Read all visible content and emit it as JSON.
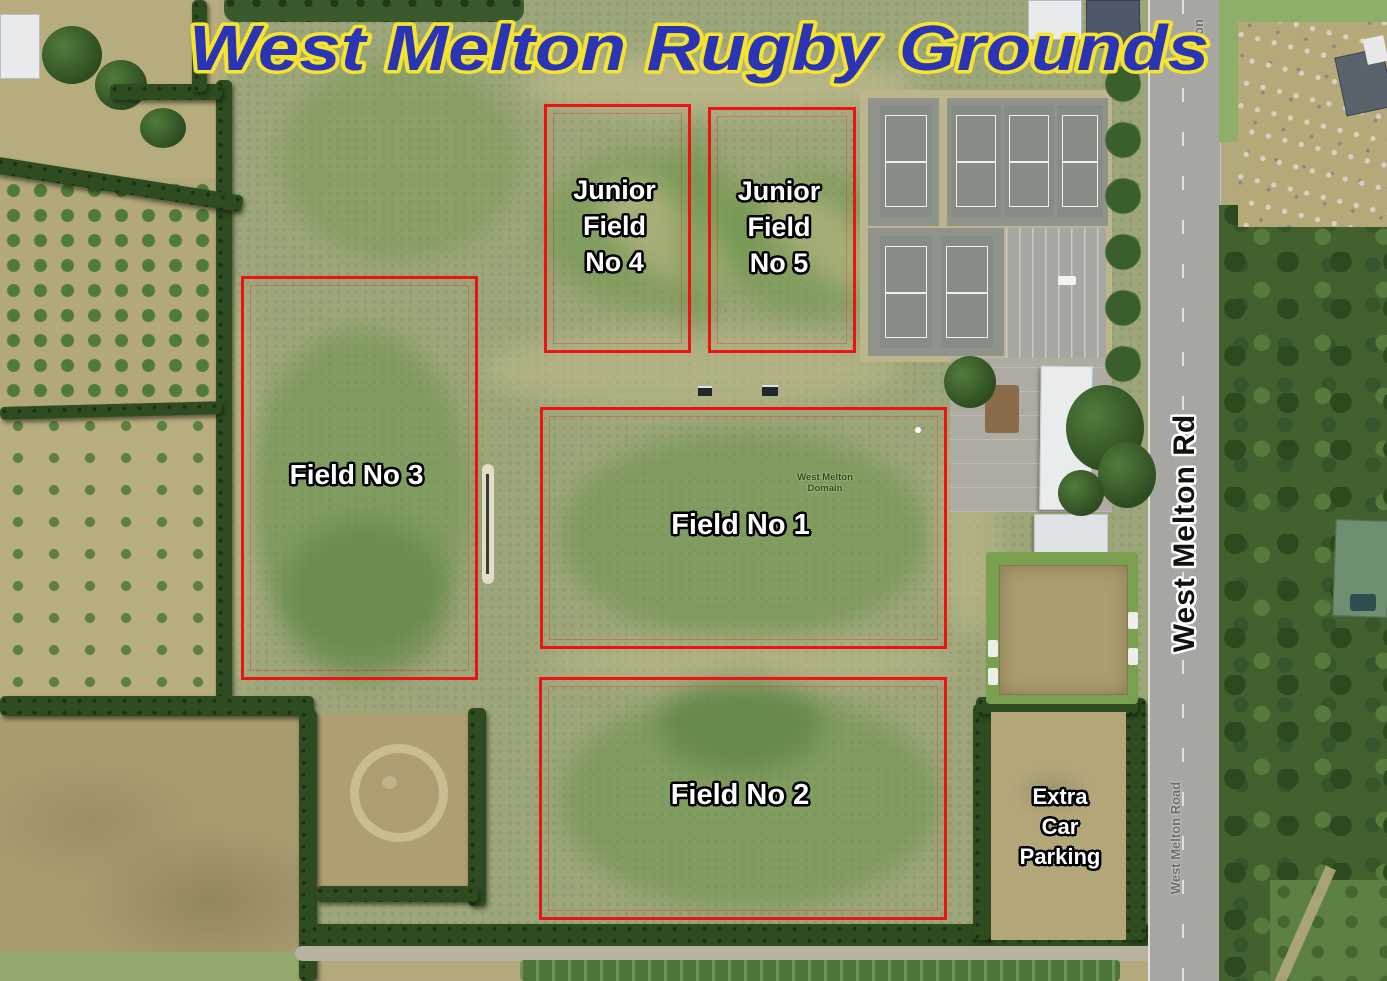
{
  "title": "West Melton Rugby Grounds",
  "colors": {
    "title_fill": "#2b34b4",
    "title_outline": "#f5e42e",
    "field_box": "#ee1212",
    "label_fill": "#ffffff",
    "label_outline": "#000000"
  },
  "fields": [
    {
      "id": "junior-field-no-4",
      "lines": [
        "Junior",
        "Field",
        "No 4"
      ]
    },
    {
      "id": "junior-field-no-5",
      "lines": [
        "Junior",
        "Field",
        "No 5"
      ]
    },
    {
      "id": "field-no-3",
      "lines": [
        "Field No 3"
      ]
    },
    {
      "id": "field-no-1",
      "lines": [
        "Field No 1"
      ]
    },
    {
      "id": "field-no-2",
      "lines": [
        "Field No 2"
      ]
    }
  ],
  "annotations": {
    "extra_parking_lines": [
      "Extra",
      "Car",
      "Parking"
    ],
    "road_label": "West Melton Rd"
  },
  "map_labels": {
    "road_name_bottom": "West Melton Road",
    "road_name_top": "Melton",
    "ground_name_line1": "West Melton",
    "ground_name_line2": "Domain"
  }
}
